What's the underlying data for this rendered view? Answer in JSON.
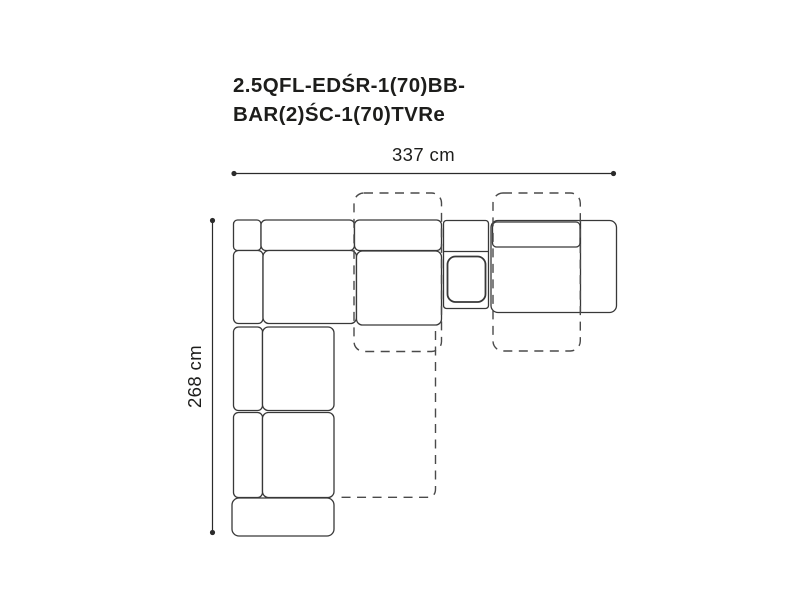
{
  "title": {
    "line1": "2.5QFL-EDŚR-1(70)BB-",
    "line2": "BAR(2)ŚC-1(70)TVRe"
  },
  "dimensions": {
    "width_label": "337 cm",
    "depth_label": "268 cm"
  },
  "diagram": {
    "type": "corner-sofa-top-view",
    "solid_outline_meaning": "sofa modules footprint",
    "dashed_outline_meaning": "extended function positions (relax / sleep extensions)"
  },
  "colors": {
    "background": "#ffffff",
    "text": "#1d1d1b",
    "line": "#383838",
    "dashed_line": "#4a4a4a",
    "dim_line": "#2b2b2b"
  }
}
